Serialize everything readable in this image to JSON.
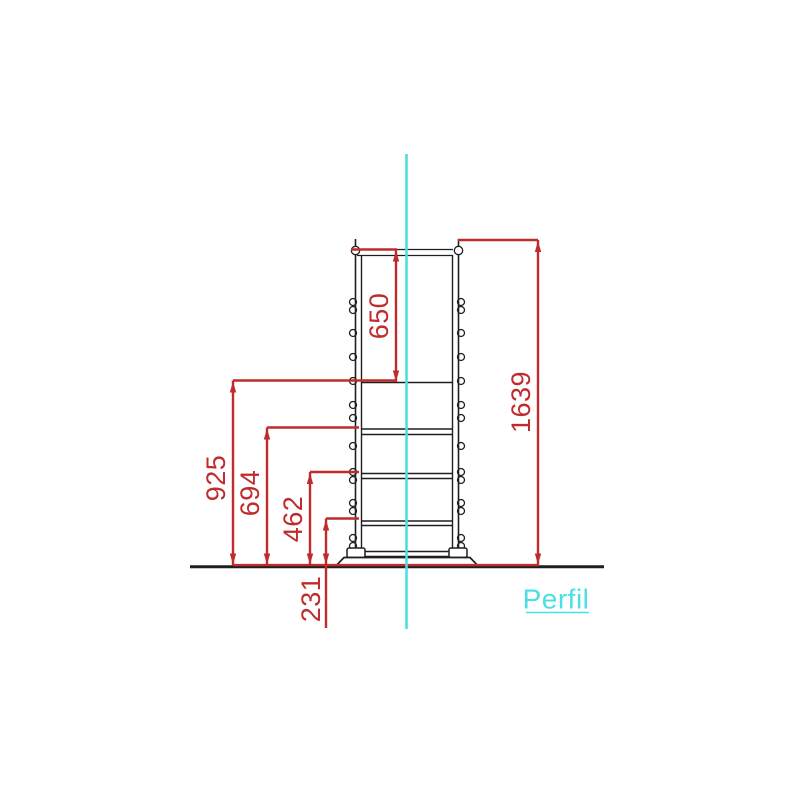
{
  "view": {
    "label": "Perfil"
  },
  "dimensions": {
    "top_bay_height": "650",
    "total_height": "1639",
    "level_925": "925",
    "level_694": "694",
    "level_462": "462",
    "level_231": "231"
  },
  "colors": {
    "dimension_red": "#c12b2b",
    "centerline_cyan": "#4adfe4",
    "structure_black": "#1f1f1f",
    "background": "#ffffff"
  }
}
